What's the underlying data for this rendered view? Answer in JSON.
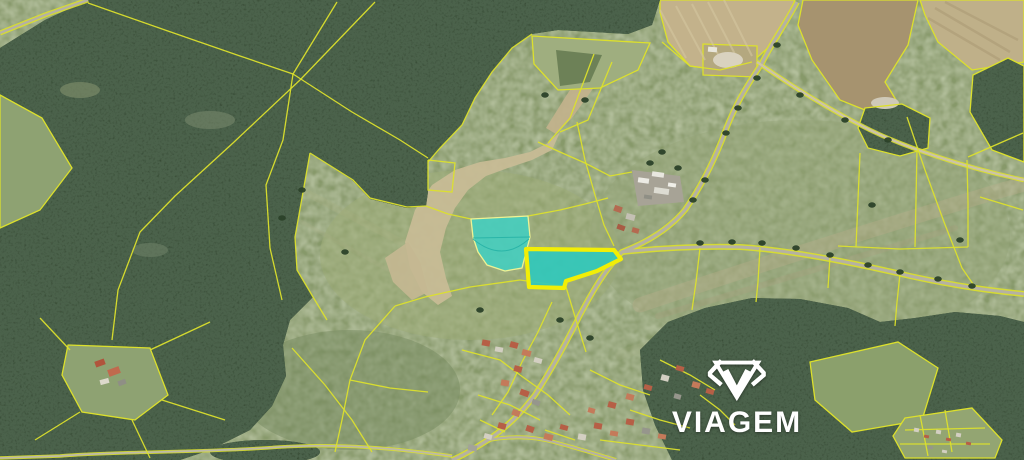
{
  "watermark": {
    "brand_text": "VIAGEM",
    "icon": "gem-diamond-icon",
    "color": "#ffffff"
  },
  "map": {
    "type": "aerial-cadastral-map",
    "description": "Satellite view with cadastral parcel overlay and two highlighted land parcels",
    "canvas": {
      "width": 1024,
      "height": 460
    },
    "palette": {
      "meadow": "#87996b",
      "meadow_light": "#9cab77",
      "forest": "#31452e",
      "cadastral_line": "#dce02c",
      "thick_outline": "#f2ee06",
      "highlight_fill": "#36cabd",
      "road_core": "#b5b1a3",
      "track_core": "#cdc4a6",
      "sand": "#c9bc96",
      "field_tan": "#c3b28b",
      "field_brown": "#a6936f",
      "field_pale": "#bfb089"
    },
    "light_patches": [
      [
        470,
        255,
        150,
        85,
        "#9cab77",
        0.55
      ],
      [
        800,
        235,
        210,
        115,
        "#95a577",
        0.45
      ],
      [
        350,
        390,
        110,
        60,
        "#76895f",
        0.5
      ]
    ],
    "forest_pale_patches": [
      [
        80,
        90,
        20,
        8,
        "#7b8a68",
        0.7
      ],
      [
        210,
        120,
        25,
        9,
        "#76876a",
        0.6
      ],
      [
        150,
        250,
        18,
        7,
        "#73856b",
        0.5
      ],
      [
        885,
        103,
        14,
        6,
        "#cfc9b8",
        1
      ],
      [
        728,
        60,
        15,
        8,
        "#d9d2bf",
        1
      ]
    ],
    "terraces": [
      {
        "d": "M640,305 C720,278 830,243 930,212 S1005,190 1024,184",
        "stroke": "#b7ad89",
        "w": 15,
        "op": 0.4
      },
      {
        "d": "M658,316 C745,290 855,258 955,228",
        "stroke": "#a89f7e",
        "w": 6,
        "op": 0.3
      },
      {
        "d": "M305,192 L424,254",
        "stroke": "#a8af83",
        "w": 7,
        "op": 0.28
      },
      {
        "d": "M302,222 L392,272",
        "stroke": "#a8af83",
        "w": 4,
        "op": 0.22
      },
      {
        "d": "M620,355 Q700,328 770,322",
        "stroke": "#9aa87a",
        "w": 10,
        "op": 0.25
      }
    ],
    "sand_shapes": [
      {
        "points": "405,242 415,210 432,185 455,170 480,162 505,158 530,152 548,143 560,132 552,150 532,160 508,168 486,176 468,190 455,208 446,228 440,252 446,278 452,296 438,305 422,292 410,268",
        "fill": "#c9bc96"
      },
      {
        "points": "385,258 408,242 420,262 428,292 412,300 393,282",
        "fill": "#c4b791"
      },
      {
        "points": "594,54 612,62 572,118 556,134 546,128 566,96",
        "fill": "#c2b28c"
      }
    ],
    "fields": [
      {
        "name": "field-stubble-top",
        "points": "660,0 795,0 779,38 752,62 720,70 690,66 668,42 660,12",
        "fill": "#c3b28b",
        "outline": true
      },
      {
        "name": "field-plowed-right",
        "points": "803,0 918,0 908,45 885,82 896,100 870,112 840,100 812,60 798,25",
        "fill": "#a6936f",
        "outline": true
      },
      {
        "name": "field-striped-corner",
        "points": "920,0 1024,0 1024,62 972,70 938,42 925,15",
        "fill": "#bfb089",
        "outline": true
      },
      {
        "name": "meadow-sage-strip",
        "points": "532,36 650,43 638,70 600,88 558,90 534,64",
        "fill": "#9fae7f",
        "outline": true
      },
      {
        "name": "field-dark-wedge",
        "points": "556,50 602,55 590,82 560,86",
        "fill": "#6d8157",
        "outline": false
      },
      {
        "name": "farm-enclosure",
        "points": "703,44 757,46 757,77 703,75",
        "fill": "#b4a87f",
        "outline": true
      }
    ],
    "field_furrows": {
      "tan": [
        [
          676,
          6,
          705,
          60
        ],
        [
          692,
          4,
          722,
          62
        ],
        [
          708,
          2,
          738,
          60
        ],
        [
          724,
          0,
          752,
          56
        ],
        [
          660,
          10,
          686,
          58
        ]
      ],
      "striped": [
        [
          935,
          8,
          1010,
          52
        ],
        [
          945,
          2,
          1018,
          40
        ],
        [
          928,
          18,
          1000,
          60
        ]
      ]
    },
    "forests": [
      {
        "name": "forest-northwest",
        "points": "88,0 660,0 652,25 628,34 594,32 558,30 532,34 512,48 492,72 475,98 462,125 440,148 428,162 428,192 426,206 407,208 370,199 352,180 310,153 295,237 297,270 313,297 290,320 283,345 286,376 272,406 250,430 210,450 180,460 0,460 0,48 45,20"
      },
      {
        "name": "forest-southeast",
        "points": "640,350 668,322 705,308 752,298 800,299 848,308 880,322 915,318 955,312 1000,316 1024,322 1024,460 672,460 655,425 643,390"
      },
      {
        "name": "forest-east-edge",
        "points": "973,75 1008,58 1024,66 1024,162 992,150 970,112"
      },
      {
        "name": "small-wood",
        "points": "865,108 902,104 930,118 928,148 900,156 868,148 858,128"
      }
    ],
    "pond": [
      265,
      452,
      55,
      12,
      "#27381f"
    ],
    "clearings": [
      {
        "name": "hamlet-clearing",
        "points": "68,345 150,348 168,395 135,420 82,412 62,375",
        "fill": "#8ea272",
        "outline": true
      },
      {
        "name": "edge-meadow-wedge",
        "points": "0,95 42,118 72,168 40,210 0,228",
        "fill": "#8ea272",
        "outline": true
      },
      {
        "name": "meadow-inlet",
        "points": "810,362 898,342 938,368 922,420 852,432 815,400",
        "fill": "#8ba06c",
        "outline": true
      },
      {
        "name": "garden-plots",
        "points": "905,418 972,408 1002,440 995,458 905,458 893,436",
        "fill": "#93a572",
        "outline": true
      }
    ],
    "roads": [
      {
        "name": "main-road",
        "d": "M797,2 C785,25 771,44 762,63 C749,83 735,103 722,140 C710,170 696,194 685,210 C670,228 648,242 622,252 C605,270 592,292 580,315 C565,345 550,372 535,395 C520,415 505,428 488,440 C472,450 462,456 452,460",
        "ew": 6,
        "cw": 3.2,
        "core": "#b5b1a3"
      },
      {
        "name": "east-road",
        "d": "M622,252 C660,248 700,246 740,247 C790,250 850,262 910,276 C960,287 995,291 1024,294",
        "ew": 6,
        "cw": 3,
        "core": "#b5b1a3"
      },
      {
        "name": "corner-road",
        "d": "M0,33 L45,15 L88,0",
        "ew": 5,
        "cw": 2.5,
        "core": "#b5b1a3"
      },
      {
        "name": "village-road",
        "d": "M488,440 C510,436 532,436 554,442 C576,448 596,454 616,460",
        "ew": 4,
        "cw": 2.2,
        "core": "#b5b1a3"
      },
      {
        "name": "south-track",
        "d": "M452,456 C400,449 340,443 280,447 C200,453 120,451 60,456 L0,458",
        "ew": 3.5,
        "cw": 1.8,
        "core": "#bdb9a8"
      },
      {
        "name": "gravel-track",
        "d": "M757,62 C790,85 830,110 870,130 C905,147 962,167 1024,180",
        "ew": 4.5,
        "cw": 2.4,
        "core": "#cdc4a6"
      }
    ],
    "cadastral_lines": [
      "88,3 165,30 240,56 293,74",
      "293,74 337,2",
      "293,74 352,112 400,140 428,158",
      "293,74 283,140 266,185 270,248 282,300",
      "375,2 300,80 233,143 175,196 140,232 118,290 112,340",
      "428,160 455,163 452,192 428,190 428,160",
      "532,34 512,48 492,72 475,98 462,125 440,148 428,162",
      "310,153 353,180 370,198 407,207 426,206",
      "310,153 295,237 297,270 313,297 327,320",
      "426,206 448,214 471,219",
      "528,216 560,210 585,204 608,198",
      "563,286 520,280 470,287 425,297 395,306",
      "395,306 365,340 350,380 342,420 335,452",
      "350,380 390,388 428,392",
      "662,42 690,66 720,70 752,62",
      "594,54 570,118 548,143",
      "612,62 588,120 560,132",
      "538,142 560,152 585,163 610,176 632,172",
      "577,122 585,160 595,195 604,225 614,246",
      "907,117 925,170 944,222 962,268 975,287",
      "860,153 858,200 856,247",
      "917,150 916,200 915,247",
      "838,246 900,249 968,247",
      "967,160 968,203 968,247",
      "968,157 1023,133",
      "980,197 1023,210",
      "700,248 696,282 692,310",
      "760,248 758,282 756,302",
      "830,257 828,288",
      "900,274 897,302 895,326",
      "566,287 576,320 586,352",
      "552,302 538,332 522,362 508,392 492,415",
      "150,350 210,322",
      "162,400 225,420",
      "132,420 150,458",
      "80,412 35,440",
      "70,350 40,318",
      "292,348 325,385 352,420 372,452",
      "462,350 500,360 520,375",
      "520,375 548,395 570,415",
      "478,395 510,405 540,420",
      "590,370 620,385 650,395",
      "600,440 640,445 680,450",
      "660,360 690,375 715,390",
      "630,410 660,420 690,428",
      "700,395 720,410 735,425",
      "545,430 575,440",
      "480,420 505,432",
      "920,415 928,456",
      "945,410 952,452",
      "905,430 985,428",
      "900,444 990,444"
    ],
    "trees": [
      [
        777,
        45
      ],
      [
        757,
        78
      ],
      [
        738,
        108
      ],
      [
        726,
        133
      ],
      [
        705,
        180
      ],
      [
        693,
        200
      ],
      [
        700,
        243
      ],
      [
        732,
        242
      ],
      [
        762,
        243
      ],
      [
        796,
        248
      ],
      [
        830,
        255
      ],
      [
        868,
        265
      ],
      [
        900,
        272
      ],
      [
        938,
        279
      ],
      [
        972,
        286
      ],
      [
        800,
        95
      ],
      [
        845,
        120
      ],
      [
        888,
        140
      ],
      [
        302,
        190
      ],
      [
        345,
        252
      ],
      [
        282,
        218
      ],
      [
        560,
        320
      ],
      [
        590,
        338
      ],
      [
        480,
        310
      ],
      [
        872,
        205
      ],
      [
        960,
        240
      ],
      [
        650,
        163
      ],
      [
        678,
        168
      ],
      [
        662,
        152
      ],
      [
        545,
        95
      ],
      [
        585,
        100
      ]
    ],
    "farm_pavement": "632,170 680,176 684,202 638,206",
    "buildings": [
      [
        638,
        178,
        11,
        5,
        8,
        "#ecebe4"
      ],
      [
        652,
        172,
        12,
        5,
        8,
        "#e8e7df"
      ],
      [
        654,
        188,
        15,
        6,
        8,
        "#dddcd2"
      ],
      [
        668,
        183,
        8,
        4,
        8,
        "#f0efe8"
      ],
      [
        644,
        195,
        8,
        4,
        8,
        "#8f8f85"
      ],
      [
        614,
        206,
        8,
        6,
        20,
        "#b46a50"
      ],
      [
        626,
        214,
        9,
        6,
        15,
        "#c4c0b4"
      ],
      [
        617,
        225,
        8,
        5,
        20,
        "#a85c44"
      ],
      [
        632,
        228,
        7,
        5,
        15,
        "#b46a50"
      ],
      [
        708,
        47,
        9,
        5,
        5,
        "#e8e6da"
      ],
      [
        95,
        360,
        10,
        6,
        -20,
        "#b0543c"
      ],
      [
        108,
        368,
        12,
        7,
        -20,
        "#c06a4e"
      ],
      [
        100,
        379,
        9,
        5,
        -15,
        "#ddd9cc"
      ],
      [
        118,
        380,
        8,
        5,
        -20,
        "#8f8f85"
      ],
      [
        482,
        340,
        8,
        6,
        10,
        "#b65f46"
      ],
      [
        495,
        347,
        8,
        5,
        10,
        "#d3cfc2"
      ],
      [
        510,
        342,
        8,
        6,
        15,
        "#b65f46"
      ],
      [
        522,
        350,
        9,
        6,
        15,
        "#c47a5a"
      ],
      [
        534,
        358,
        8,
        5,
        15,
        "#d3cfc2"
      ],
      [
        514,
        366,
        8,
        6,
        15,
        "#b65f46"
      ],
      [
        501,
        380,
        8,
        6,
        10,
        "#c47a5a"
      ],
      [
        520,
        390,
        9,
        6,
        20,
        "#b65f46"
      ],
      [
        532,
        400,
        8,
        5,
        20,
        "#96968c"
      ],
      [
        512,
        410,
        8,
        6,
        20,
        "#c47a5a"
      ],
      [
        498,
        423,
        8,
        6,
        15,
        "#b65f46"
      ],
      [
        484,
        434,
        8,
        5,
        15,
        "#d3cfc2"
      ],
      [
        526,
        426,
        8,
        6,
        20,
        "#b65f46"
      ],
      [
        544,
        434,
        9,
        6,
        15,
        "#c47a5a"
      ],
      [
        560,
        425,
        8,
        5,
        15,
        "#b65f46"
      ],
      [
        578,
        434,
        8,
        6,
        10,
        "#d3cfc2"
      ],
      [
        594,
        423,
        8,
        6,
        10,
        "#b65f46"
      ],
      [
        610,
        431,
        8,
        5,
        10,
        "#c47a5a"
      ],
      [
        626,
        419,
        8,
        6,
        10,
        "#b65f46"
      ],
      [
        642,
        428,
        8,
        6,
        10,
        "#96968c"
      ],
      [
        658,
        434,
        8,
        5,
        10,
        "#c47a5a"
      ],
      [
        608,
        402,
        8,
        6,
        15,
        "#b65f46"
      ],
      [
        626,
        394,
        8,
        6,
        15,
        "#c47a5a"
      ],
      [
        644,
        385,
        8,
        5,
        15,
        "#b65f46"
      ],
      [
        661,
        375,
        8,
        6,
        15,
        "#d3cfc2"
      ],
      [
        676,
        366,
        8,
        5,
        15,
        "#b65f46"
      ],
      [
        692,
        382,
        8,
        6,
        15,
        "#c47a5a"
      ],
      [
        706,
        389,
        8,
        5,
        15,
        "#b65f46"
      ],
      [
        674,
        394,
        7,
        5,
        15,
        "#96968c"
      ],
      [
        588,
        408,
        7,
        5,
        15,
        "#c47a5a"
      ],
      [
        468,
        445,
        9,
        6,
        10,
        "#a3a399"
      ],
      [
        914,
        428,
        5,
        4,
        10,
        "#d3cfc2"
      ],
      [
        924,
        435,
        5,
        3,
        10,
        "#b65f46"
      ],
      [
        936,
        430,
        5,
        4,
        10,
        "#d3cfc2"
      ],
      [
        946,
        438,
        5,
        3,
        10,
        "#b65f46"
      ],
      [
        956,
        433,
        5,
        4,
        10,
        "#d3cfc2"
      ],
      [
        966,
        442,
        5,
        3,
        10,
        "#b65f46"
      ],
      [
        928,
        446,
        5,
        3,
        10,
        "#96968c"
      ],
      [
        942,
        450,
        5,
        3,
        10,
        "#d3cfc2"
      ]
    ],
    "highlight_parcels": [
      {
        "name": "highlighted-parcel-upper",
        "points": "471,219 528,216 530,237 522,268 505,271 487,265 478,252 473,237",
        "fill": "#3fd0c3",
        "fill_opacity": 0.85,
        "stroke": "#eef293",
        "stroke_w": 1.3,
        "inner_lines": [
          "M473,238 L530,237",
          "M473,239 Q502,263 529,239"
        ]
      },
      {
        "name": "highlighted-parcel-lower",
        "points": "526,249 614,250 621,259 597,271 566,281 564,288 529,287",
        "fill": "#2fc9bc",
        "fill_opacity": 0.9,
        "stroke": "#f2ee06",
        "stroke_w": 4.2,
        "inner_lines": []
      }
    ]
  }
}
